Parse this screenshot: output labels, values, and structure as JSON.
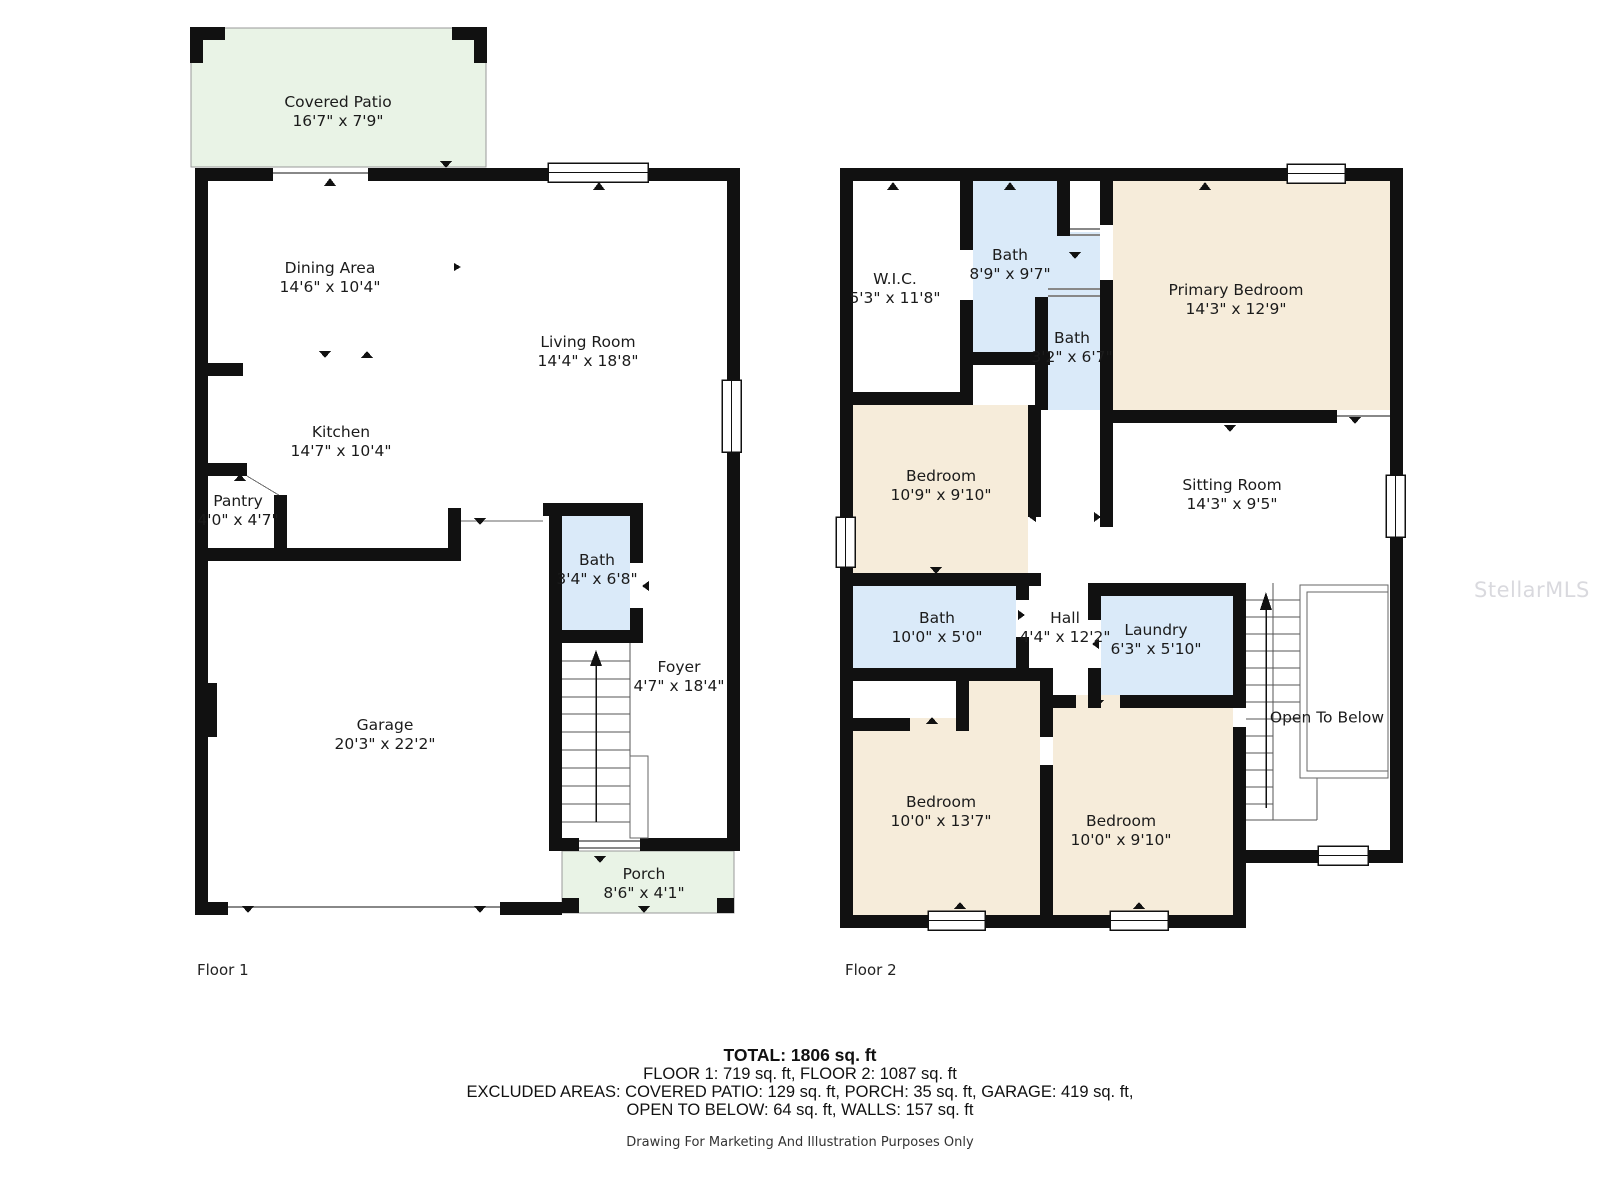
{
  "floors": [
    {
      "label": "Floor 1",
      "rooms": [
        {
          "name": "Covered Patio",
          "dims": "16'7\" x 7'9\""
        },
        {
          "name": "Dining Area",
          "dims": "14'6\" x 10'4\""
        },
        {
          "name": "Living Room",
          "dims": "14'4\" x 18'8\""
        },
        {
          "name": "Kitchen",
          "dims": "14'7\" x 10'4\""
        },
        {
          "name": "Pantry",
          "dims": "4'0\" x 4'7\""
        },
        {
          "name": "Bath",
          "dims": "3'4\" x 6'8\""
        },
        {
          "name": "Foyer",
          "dims": "4'7\" x 18'4\""
        },
        {
          "name": "Garage",
          "dims": "20'3\" x 22'2\""
        },
        {
          "name": "Porch",
          "dims": "8'6\" x 4'1\""
        }
      ]
    },
    {
      "label": "Floor 2",
      "rooms": [
        {
          "name": "W.I.C.",
          "dims": "5'3\" x 11'8\""
        },
        {
          "name": "Bath",
          "dims": "8'9\" x 9'7\""
        },
        {
          "name": "Bath",
          "dims": "3'2\" x 6'7\""
        },
        {
          "name": "Primary Bedroom",
          "dims": "14'3\" x 12'9\""
        },
        {
          "name": "Bedroom",
          "dims": "10'9\" x 9'10\""
        },
        {
          "name": "Sitting Room",
          "dims": "14'3\" x 9'5\""
        },
        {
          "name": "Bath",
          "dims": "10'0\" x 5'0\""
        },
        {
          "name": "Hall",
          "dims": "4'4\" x 12'2\""
        },
        {
          "name": "Laundry",
          "dims": "6'3\" x 5'10\""
        },
        {
          "name": "Bedroom",
          "dims": "10'0\" x 13'7\""
        },
        {
          "name": "Bedroom",
          "dims": "10'0\" x 9'10\""
        },
        {
          "name": "Open To Below",
          "dims": ""
        }
      ]
    }
  ],
  "summary": {
    "total_line": "TOTAL: 1806 sq. ft",
    "floors_line": "FLOOR 1: 719 sq. ft, FLOOR 2: 1087 sq. ft",
    "excluded_line": "EXCLUDED AREAS: COVERED PATIO: 129 sq. ft, PORCH: 35 sq. ft, GARAGE: 419 sq. ft,",
    "excluded_line2": "OPEN TO BELOW: 64 sq. ft, WALLS: 157 sq. ft",
    "disclaimer": "Drawing For Marketing And Illustration Purposes Only"
  },
  "watermark": "StellarMLS",
  "colors": {
    "wall": "#111111",
    "bedroom_fill": "#f6ecda",
    "bath_fill": "#daeaf9",
    "outdoor_fill": "#e9f3e6",
    "watermark_color": "#b9b9c3"
  }
}
